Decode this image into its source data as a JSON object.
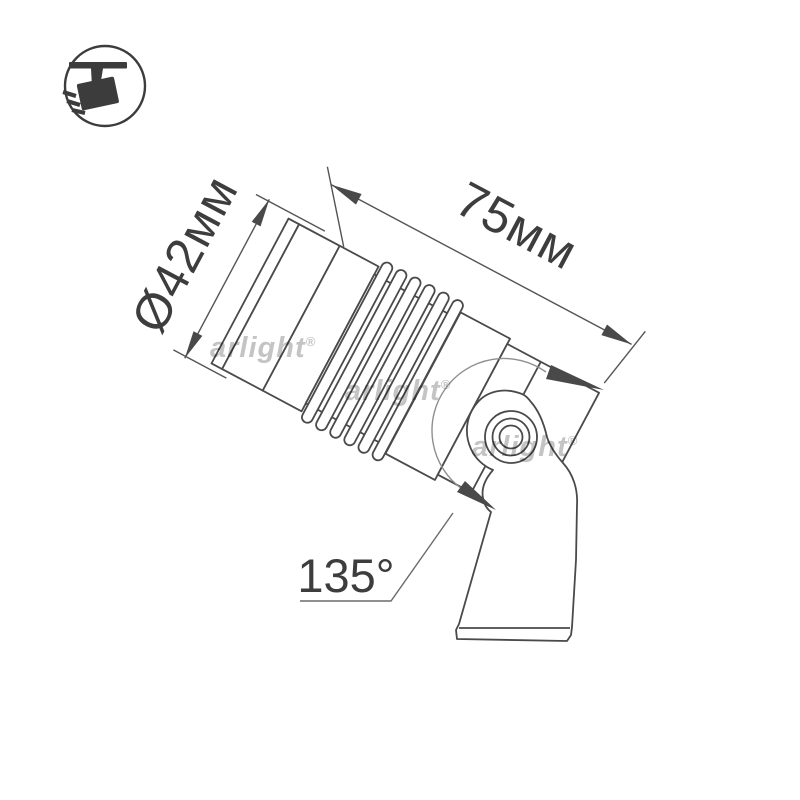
{
  "canvas": {
    "background": "#ffffff",
    "description": "spotlight-dimension-drawing"
  },
  "badge_icon": {
    "name": "ceiling-spotlight-badge"
  },
  "drawing": {
    "dimensions": {
      "diameter_label": "Ø42мм",
      "length_label": "75мм",
      "rotation_angle_label": "135°"
    },
    "watermark": {
      "text": "arlight",
      "symbol": "®",
      "visible_instances": 3
    },
    "colors": {
      "outline": "#4a4a4a",
      "dimension": "#555555",
      "label_text": "#3d3d3d",
      "rotation_arc": "#8f8f8f",
      "watermark": "#c4c4c4",
      "icon": "#3c3c3c",
      "background": "#ffffff"
    }
  }
}
